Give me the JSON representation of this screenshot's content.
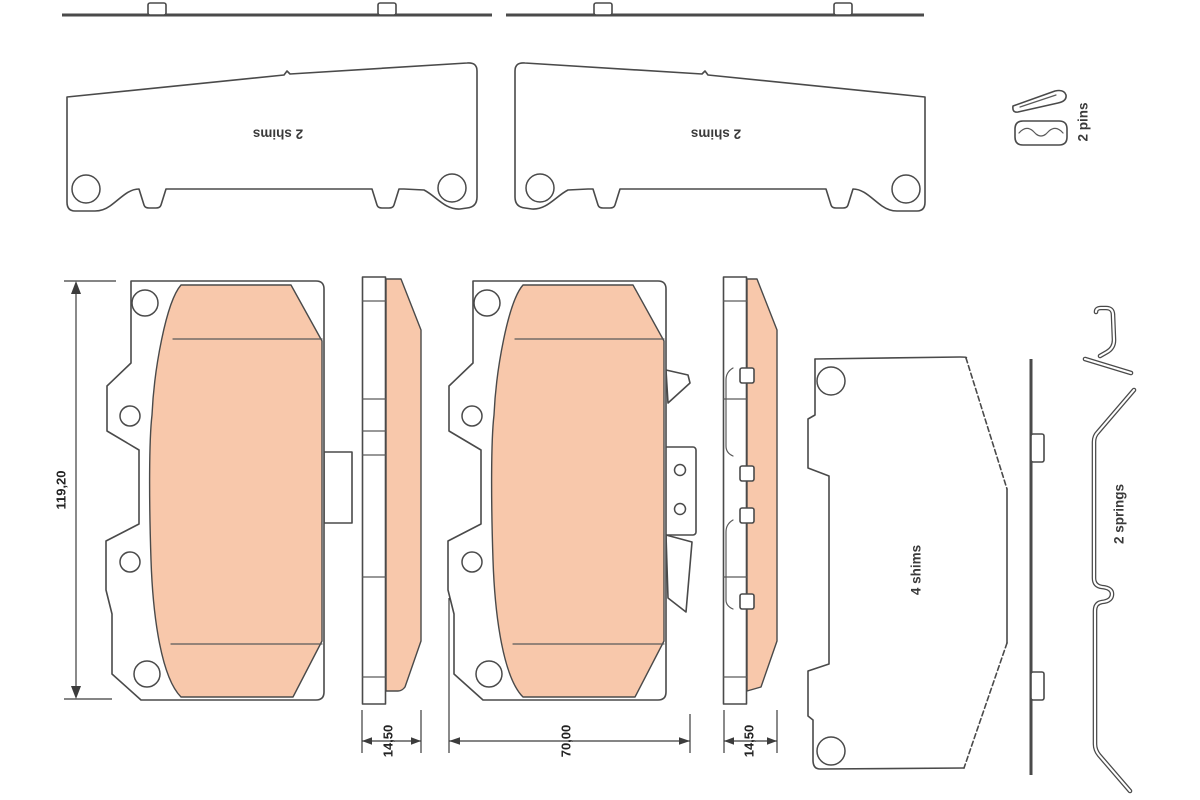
{
  "drawing": {
    "type": "brake-pad-set-technical-drawing",
    "labels": {
      "shim_left": "2 shims",
      "shim_right": "2 shims",
      "pins": "2 pins",
      "shims_inner": "4 shims",
      "springs": "2 springs"
    },
    "dimensions": {
      "pad_height_mm": "119,20",
      "pad_thickness_left_mm": "14,50",
      "pad_width_mm": "70,00",
      "pad_thickness_right_mm": "14,50"
    },
    "colors": {
      "friction_material": "#f8c8ab",
      "outline": "#4a4a4a",
      "background": "#ffffff"
    }
  }
}
